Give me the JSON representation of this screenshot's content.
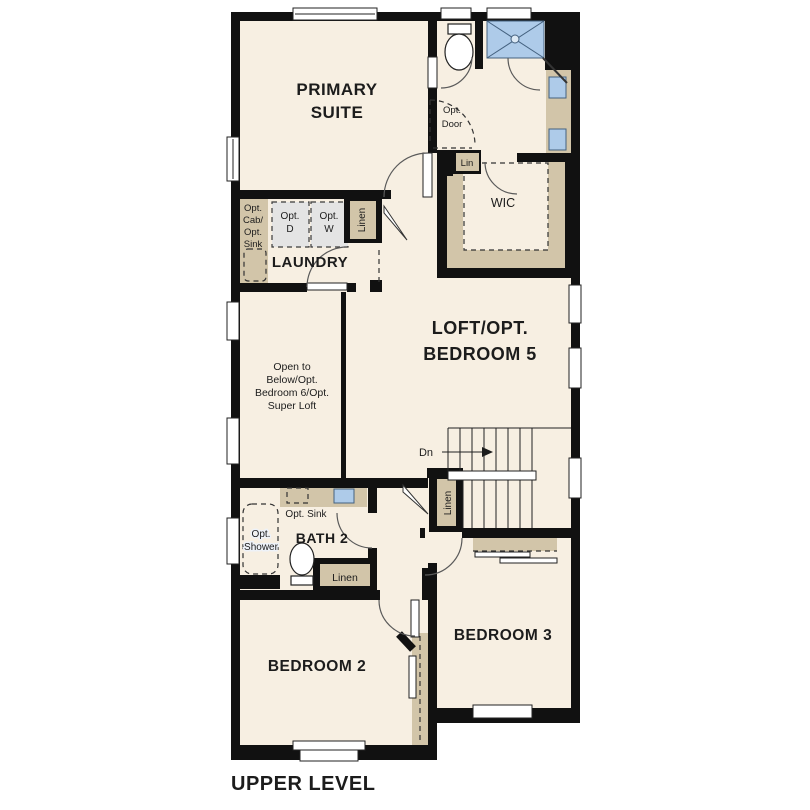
{
  "title": {
    "text": "UPPER LEVEL"
  },
  "rooms": {
    "primary_suite": {
      "line1": "PRIMARY",
      "line2": "SUITE"
    },
    "laundry": {
      "label": "LAUNDRY"
    },
    "loft": {
      "line1": "LOFT/OPT.",
      "line2": "BEDROOM 5"
    },
    "open_to_below": {
      "line1": "Open to",
      "line2": "Below/Opt.",
      "line3": "Bedroom 6/Opt.",
      "line4": "Super Loft"
    },
    "bath2": {
      "label": "BATH 2"
    },
    "bedroom2": {
      "label": "BEDROOM 2"
    },
    "bedroom3": {
      "label": "BEDROOM 3"
    },
    "wic": {
      "label": "WIC"
    }
  },
  "annotations": {
    "opt_cab_sink": {
      "line1": "Opt.",
      "line2": "Cab/",
      "line3": "Opt.",
      "line4": "Sink"
    },
    "opt_dryer": {
      "line1": "Opt.",
      "line2": "D"
    },
    "opt_washer": {
      "line1": "Opt.",
      "line2": "W"
    },
    "linen_hall": {
      "label": "Linen"
    },
    "lin_wic": {
      "label": "Lin"
    },
    "opt_door": {
      "line1": "Opt.",
      "line2": "Door"
    },
    "opt_sink_bath2": {
      "label": "Opt. Sink"
    },
    "opt_shower": {
      "line1": "Opt.",
      "line2": "Shower"
    },
    "linen_bath2": {
      "label": "Linen"
    },
    "linen_stairs": {
      "label": "Linen"
    },
    "stairs_dn": {
      "label": "Dn"
    }
  },
  "colors": {
    "background": "#ffffff",
    "floor": "#f7efe2",
    "wall": "#111111",
    "cabinet_tan": "#d2c5a9",
    "appliance_gray": "#e4e4e4",
    "fixture_blue": "#aecbe9",
    "text": "#1c1c1c"
  }
}
